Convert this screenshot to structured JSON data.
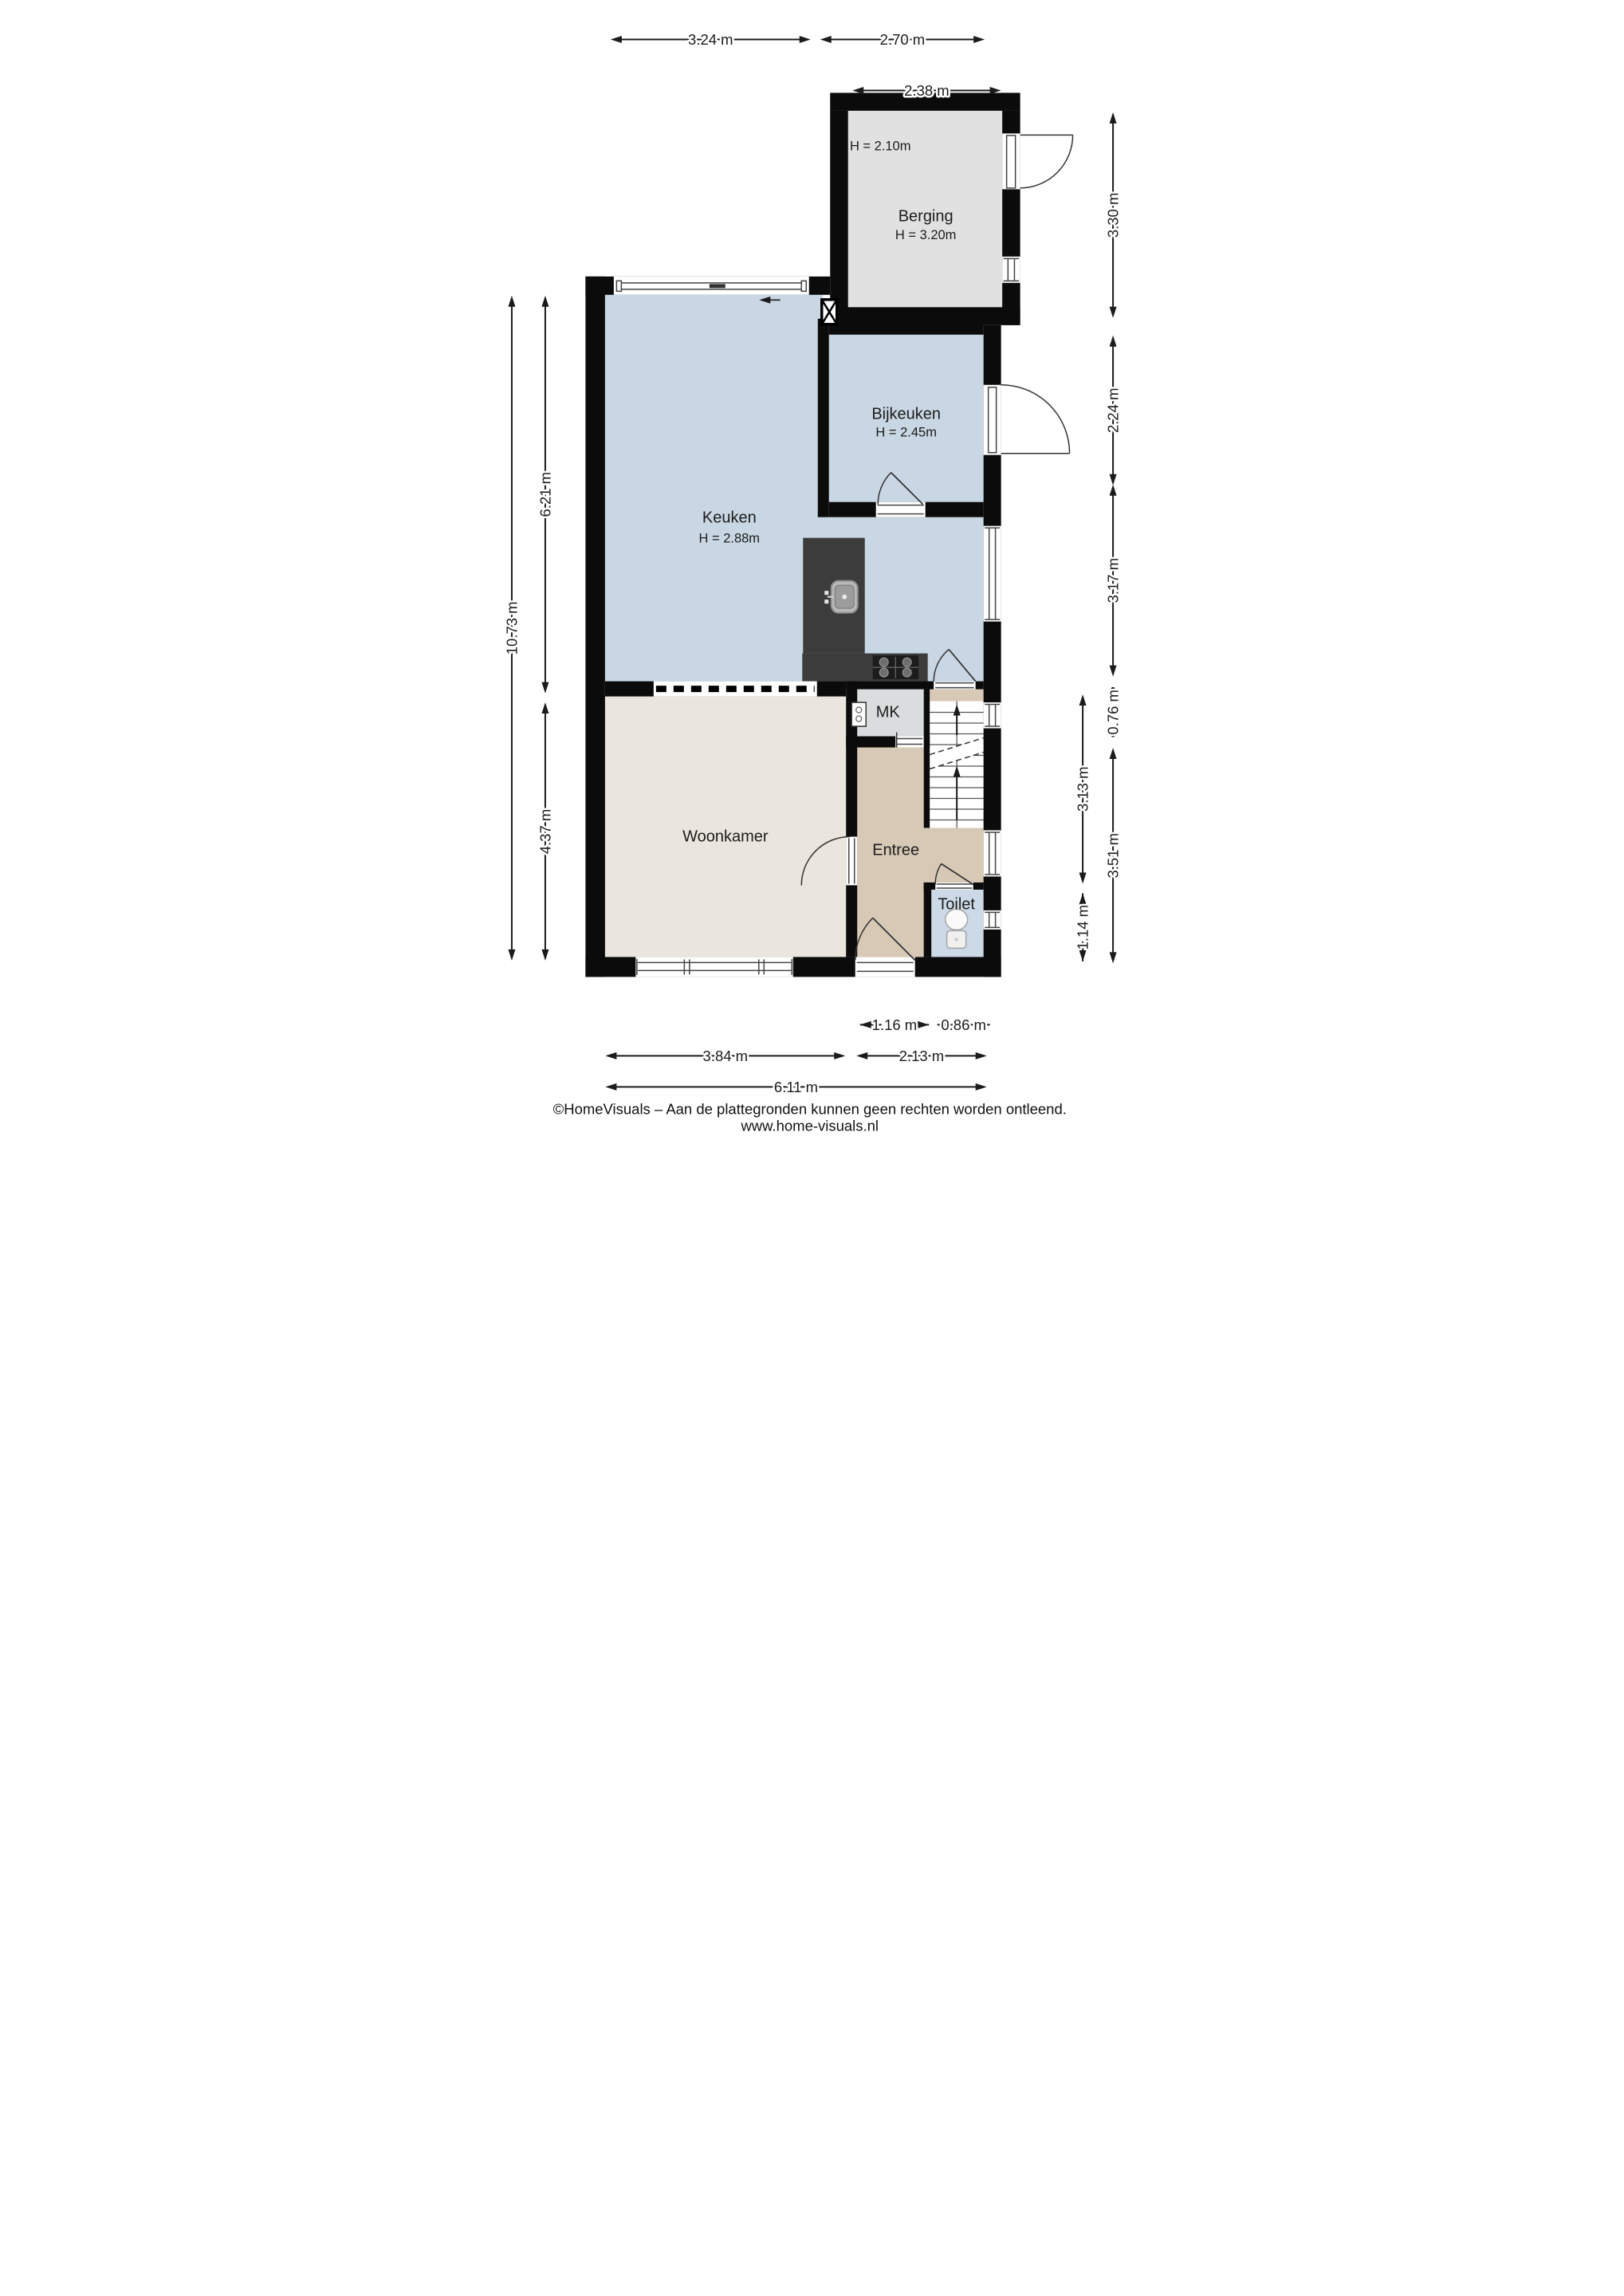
{
  "plan_type": "floor-plan",
  "rooms": {
    "berging": {
      "label": "Berging",
      "height": "H = 3.20m",
      "note": "H = 2.10m"
    },
    "bijkeuken": {
      "label": "Bijkeuken",
      "height": "H = 2.45m"
    },
    "keuken": {
      "label": "Keuken",
      "height": "H = 2.88m"
    },
    "woonkamer": {
      "label": "Woonkamer"
    },
    "entree": {
      "label": "Entree"
    },
    "toilet": {
      "label": "Toilet"
    },
    "meterkast": {
      "label": "MK"
    }
  },
  "dims": {
    "t324": {
      "text": "3.24 m"
    },
    "t270": {
      "text": "2.70 m"
    },
    "t238": {
      "text": "2.38 m"
    },
    "b116": {
      "text": "1.16 m"
    },
    "b086": {
      "text": "0.86 m"
    },
    "b384": {
      "text": "3.84 m"
    },
    "b213": {
      "text": "2.13 m"
    },
    "b611": {
      "text": "6.11 m"
    },
    "l1073": {
      "text": "10.73 m"
    },
    "l621": {
      "text": "6.21 m"
    },
    "l437": {
      "text": "4.37 m"
    },
    "r330": {
      "text": "3.30 m"
    },
    "r224": {
      "text": "2.24 m"
    },
    "r317": {
      "text": "3.17 m"
    },
    "r076": {
      "text": "0.76 m"
    },
    "r351": {
      "text": "3.51 m"
    },
    "r313": {
      "text": "3.13 m"
    },
    "r114": {
      "text": "1.14 m"
    }
  },
  "symbols": {
    "stairs": "stairs-up-arrows",
    "shaft": "x-box-duct",
    "toilet_fixture": "wc",
    "meter_box": "meterkast-symbol",
    "sliding_door_arrow": "arrow-left"
  },
  "colors": {
    "wall": "#0b0b0b",
    "berging_floor": "#e1e1e1",
    "kitchen_floor": "#c9d7e4",
    "utility_floor": "#c9d7e4",
    "toilet_floor": "#ccd9e6",
    "living_floor": "#eae6dd",
    "hall_floor": "#d8c9b6",
    "mk_floor": "#d9dddd",
    "counter": "#3c3c3c",
    "hob": "#1c1c1c",
    "line": "#1b1b1b",
    "frame": "#444444"
  },
  "footer": {
    "line1": "©HomeVisuals – Aan de plattegronden kunnen geen rechten worden ontleend.",
    "line2": "www.home-visuals.nl"
  }
}
